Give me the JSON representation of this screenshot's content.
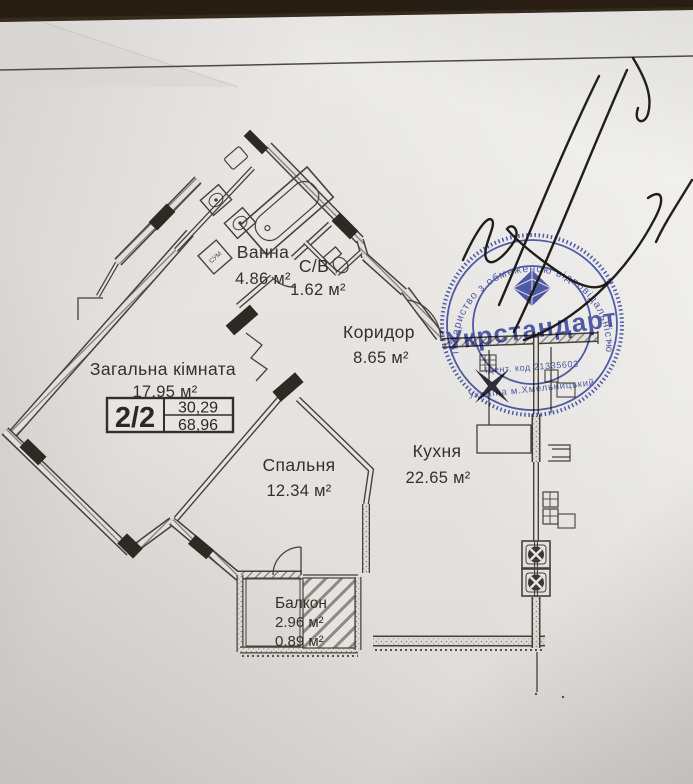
{
  "plan": {
    "rooms": [
      {
        "id": "vanna",
        "name": "Ванна",
        "area": "4.86 м²"
      },
      {
        "id": "sv",
        "name": "С/В",
        "area": "1.62 м²"
      },
      {
        "id": "korydor",
        "name": "Коридор",
        "area": "8.65 м²"
      },
      {
        "id": "zahalna",
        "name": "Загальна кімната",
        "area": "17.95 м²"
      },
      {
        "id": "spalnia",
        "name": "Спальня",
        "area": "12.34 м²"
      },
      {
        "id": "kukhnia",
        "name": "Кухня",
        "area": "22.65 м²"
      },
      {
        "id": "balkon",
        "name": "Балкон",
        "area": "2.96 м²",
        "area2": "0.89 м²"
      }
    ],
    "info_box": {
      "apartment": "2/2",
      "upper_value": "30,29",
      "lower_value": "68,96"
    },
    "fixtures": {
      "washer_label": "СУМ"
    }
  },
  "stamp": {
    "ring_text": "Товариство з обмеженою відповідальністю",
    "company": "Укрстандарт",
    "id_line": "Ідент. код 21335603",
    "location": "Україна м.Хмельницький",
    "color": "#2b3aa5"
  }
}
